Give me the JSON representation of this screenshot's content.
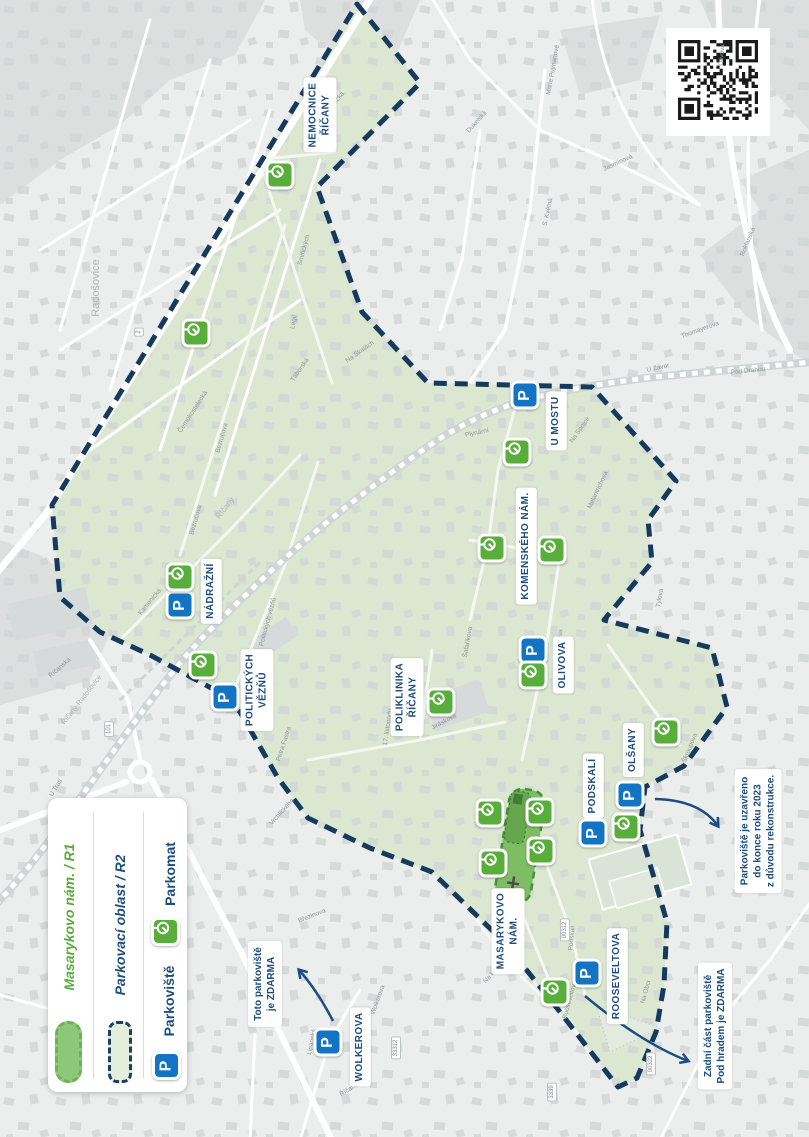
{
  "colors": {
    "boundary_navy": "#16395e",
    "label_navy": "#1b4d7d",
    "legend_green": "#58ab3c",
    "parking_blue": "#1374c4",
    "parkomat_green": "#58ad3b",
    "zone_r2_fill": "#dbe7d1",
    "zone_r1_fill": "#7fbd64"
  },
  "legend": {
    "items": [
      {
        "id": "r1",
        "label": "Masarykovo nám. / R1",
        "swatch": "green-pill"
      },
      {
        "id": "r2",
        "label": "Parkovací oblast / R2",
        "swatch": "dashed-area"
      },
      {
        "id": "parkoviste",
        "label": "Parkoviště",
        "swatch": "p-icon"
      },
      {
        "id": "parkomat",
        "label": "Parkomat",
        "swatch": "parkomat-icon"
      }
    ]
  },
  "icons": {
    "parking_glyph": "P"
  },
  "area_labels": [
    {
      "lines": [
        "NEMOCNICE",
        "ŘÍČANY"
      ],
      "x": 320,
      "y": 115
    },
    {
      "lines": [
        "U MOSTU"
      ],
      "x": 556,
      "y": 421
    },
    {
      "lines": [
        "KOMENSKÉHO NÁM."
      ],
      "x": 526,
      "y": 546
    },
    {
      "lines": [
        "NÁDRAŽNÍ"
      ],
      "x": 211,
      "y": 591
    },
    {
      "lines": [
        "POLITICKÝCH",
        "VĚZŇŮ"
      ],
      "x": 257,
      "y": 690
    },
    {
      "lines": [
        "POLIKLINIKA",
        "ŘÍČANY"
      ],
      "x": 407,
      "y": 697
    },
    {
      "lines": [
        "OLIVOVA"
      ],
      "x": 563,
      "y": 665
    },
    {
      "lines": [
        "OLŠANY"
      ],
      "x": 633,
      "y": 750
    },
    {
      "lines": [
        "PODSKALÍ"
      ],
      "x": 593,
      "y": 786
    },
    {
      "lines": [
        "MASARYKOVO",
        "NÁM."
      ],
      "x": 508,
      "y": 931
    },
    {
      "lines": [
        "ROOSEVELTOVA"
      ],
      "x": 617,
      "y": 976
    },
    {
      "lines": [
        "WOLKEROVA"
      ],
      "x": 360,
      "y": 1047
    }
  ],
  "callouts": [
    {
      "lines": [
        "Toto parkoviště",
        "je ZDARMA"
      ],
      "x": 265,
      "y": 984
    },
    {
      "lines": [
        "Parkoviště je uzavřeno",
        "do konce roku 2023",
        "z důvodu rekonstrukce."
      ],
      "x": 758,
      "y": 831
    },
    {
      "lines": [
        "Zadní část parkoviště",
        "Pod hradem je ZDARMA"
      ],
      "x": 715,
      "y": 1026
    }
  ],
  "parking_icons": [
    {
      "x": 525,
      "y": 395
    },
    {
      "x": 180,
      "y": 605
    },
    {
      "x": 225,
      "y": 697
    },
    {
      "x": 533,
      "y": 650
    },
    {
      "x": 630,
      "y": 795
    },
    {
      "x": 593,
      "y": 833
    },
    {
      "x": 587,
      "y": 973
    },
    {
      "x": 328,
      "y": 1042
    }
  ],
  "parkomat_icons": [
    {
      "x": 280,
      "y": 175
    },
    {
      "x": 196,
      "y": 333
    },
    {
      "x": 180,
      "y": 577
    },
    {
      "x": 203,
      "y": 665
    },
    {
      "x": 517,
      "y": 452
    },
    {
      "x": 492,
      "y": 548
    },
    {
      "x": 552,
      "y": 550
    },
    {
      "x": 441,
      "y": 702
    },
    {
      "x": 533,
      "y": 675
    },
    {
      "x": 666,
      "y": 732
    },
    {
      "x": 626,
      "y": 827
    },
    {
      "x": 490,
      "y": 813
    },
    {
      "x": 540,
      "y": 812
    },
    {
      "x": 541,
      "y": 851
    },
    {
      "x": 493,
      "y": 863
    },
    {
      "x": 555,
      "y": 992
    }
  ],
  "street_labels": [
    {
      "t": "Černokostelecká",
      "x": 193,
      "y": 412,
      "a": -57
    },
    {
      "t": "Bezručova",
      "x": 222,
      "y": 438,
      "a": -74
    },
    {
      "t": "Bezručova",
      "x": 196,
      "y": 520,
      "a": -74
    },
    {
      "t": "Smiřických",
      "x": 304,
      "y": 250,
      "a": -75
    },
    {
      "t": "Domažlická",
      "x": 333,
      "y": 106,
      "a": -52
    },
    {
      "t": "Legií",
      "x": 294,
      "y": 322,
      "a": -78
    },
    {
      "t": "Táborská",
      "x": 300,
      "y": 370,
      "a": -55
    },
    {
      "t": "Na Skalách",
      "x": 360,
      "y": 352,
      "a": -35
    },
    {
      "t": "Kamenická",
      "x": 150,
      "y": 602,
      "a": -50
    },
    {
      "t": "Politických vězňů",
      "x": 268,
      "y": 622,
      "a": -75
    },
    {
      "t": "Pod Drahou",
      "x": 748,
      "y": 371,
      "a": -6
    },
    {
      "t": "U Závor",
      "x": 658,
      "y": 368,
      "a": -12
    },
    {
      "t": "Olivova",
      "x": 560,
      "y": 640,
      "a": -85
    },
    {
      "t": "Olivova",
      "x": 722,
      "y": 55,
      "a": -85
    },
    {
      "t": "Roklanská",
      "x": 748,
      "y": 242,
      "a": -68
    },
    {
      "t": "Jasmínová",
      "x": 618,
      "y": 163,
      "a": -25
    },
    {
      "t": "Marie Pujmanové",
      "x": 553,
      "y": 70,
      "a": -80
    },
    {
      "t": "S. Květná",
      "x": 548,
      "y": 212,
      "a": -78
    },
    {
      "t": "Dukelská",
      "x": 477,
      "y": 122,
      "a": -48
    },
    {
      "t": "Tylova",
      "x": 660,
      "y": 598,
      "a": -80
    },
    {
      "t": "Škroupova",
      "x": 690,
      "y": 748,
      "a": -68
    },
    {
      "t": "Šafaříkova",
      "x": 468,
      "y": 642,
      "a": -80
    },
    {
      "t": "17. listopadu",
      "x": 388,
      "y": 727,
      "a": -82
    },
    {
      "t": "Jiráskova",
      "x": 444,
      "y": 722,
      "a": -28
    },
    {
      "t": "Plynární",
      "x": 477,
      "y": 433,
      "a": -12
    },
    {
      "t": "Na Spojce",
      "x": 580,
      "y": 430,
      "a": -55
    },
    {
      "t": "Melantrichova",
      "x": 598,
      "y": 490,
      "a": -65
    },
    {
      "t": "Thomayerova",
      "x": 700,
      "y": 330,
      "a": -20
    },
    {
      "t": "Rooseveltova",
      "x": 570,
      "y": 1000,
      "a": -75
    },
    {
      "t": "Podskalí",
      "x": 572,
      "y": 938,
      "a": -85
    },
    {
      "t": "Na Hradě",
      "x": 494,
      "y": 972,
      "a": -48
    },
    {
      "t": "Na Obci",
      "x": 646,
      "y": 992,
      "a": -75
    },
    {
      "t": "Říčanská",
      "x": 60,
      "y": 668,
      "a": -42
    },
    {
      "t": "Říčanská",
      "x": 352,
      "y": 1088,
      "a": -32
    },
    {
      "t": "U Trati",
      "x": 56,
      "y": 788,
      "a": -58
    },
    {
      "t": "Lipanská",
      "x": 312,
      "y": 1042,
      "a": -78
    },
    {
      "t": "Vrchlického",
      "x": 282,
      "y": 812,
      "a": -48
    },
    {
      "t": "Petra Fastra",
      "x": 284,
      "y": 744,
      "a": -72
    },
    {
      "t": "Březinova",
      "x": 312,
      "y": 916,
      "a": -22
    },
    {
      "t": "Wolkerova",
      "x": 378,
      "y": 1000,
      "a": -70
    }
  ],
  "place_labels": [
    {
      "t": "Radošovice",
      "x": 96,
      "y": 288,
      "a": -90,
      "s": 11
    },
    {
      "t": "Říčany-Radošovice",
      "x": 82,
      "y": 700,
      "a": -52,
      "s": 7
    },
    {
      "t": "Říčany",
      "x": 225,
      "y": 508,
      "a": -52,
      "s": 8
    }
  ],
  "route_badges": [
    {
      "t": "2",
      "x": 139,
      "y": 332
    },
    {
      "t": "101",
      "x": 109,
      "y": 729
    },
    {
      "t": "33312",
      "x": 396,
      "y": 1048
    },
    {
      "t": "3339",
      "x": 552,
      "y": 1092
    },
    {
      "t": "00312",
      "x": 565,
      "y": 930
    },
    {
      "t": "00322",
      "x": 651,
      "y": 1064
    }
  ]
}
